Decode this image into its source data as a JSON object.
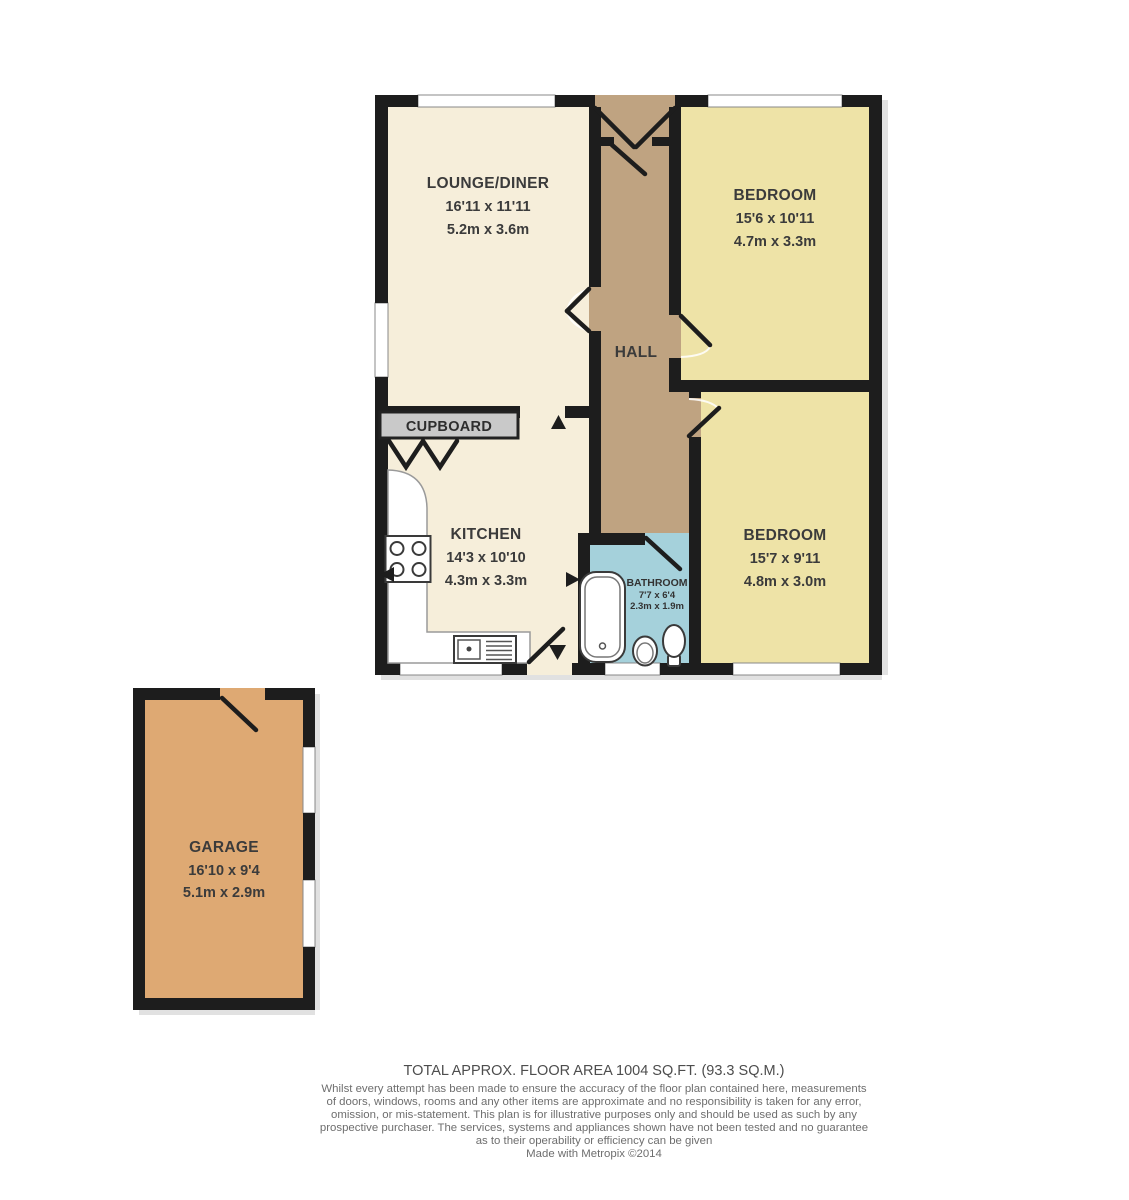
{
  "plan": {
    "title": "Floor plan",
    "colors": {
      "wall": "#1d1d1d",
      "cream_floor": "#f6eeda",
      "hall_floor": "#bfa381",
      "bedroom_floor": "#eee3a7",
      "bathroom_floor": "#a5d1db",
      "garage_floor": "#dea973",
      "cupboard_fill": "#c9c9c9"
    },
    "rooms": [
      {
        "name": "LOUNGE/DINER",
        "imperial": "16'11 x 11'11",
        "metric": "5.2m x 3.6m"
      },
      {
        "name": "BEDROOM",
        "imperial": "15'6 x 10'11",
        "metric": "4.7m x 3.3m"
      },
      {
        "name": "HALL"
      },
      {
        "name": "CUPBOARD"
      },
      {
        "name": "KITCHEN",
        "imperial": "14'3 x 10'10",
        "metric": "4.3m x 3.3m"
      },
      {
        "name": "BATHROOM",
        "imperial": "7'7 x 6'4",
        "metric": "2.3m x 1.9m"
      },
      {
        "name": "BEDROOM",
        "imperial": "15'7 x 9'11",
        "metric": "4.8m x 3.0m"
      },
      {
        "name": "GARAGE",
        "imperial": "16'10 x 9'4",
        "metric": "5.1m x 2.9m"
      }
    ]
  },
  "footer": {
    "total_area": "TOTAL APPROX. FLOOR AREA 1004 SQ.FT. (93.3 SQ.M.)",
    "disclaimer": [
      "Whilst every attempt has been made to ensure the accuracy of the floor plan contained here, measurements",
      "of doors, windows, rooms and any other items are approximate and no responsibility is taken for any error,",
      "omission, or mis-statement. This plan is for illustrative purposes only and should be used as such by any",
      "prospective purchaser. The services, systems and appliances shown have not been tested and no guarantee",
      "as to their operability or efficiency can be given"
    ],
    "credit": "Made with Metropix ©2014"
  }
}
